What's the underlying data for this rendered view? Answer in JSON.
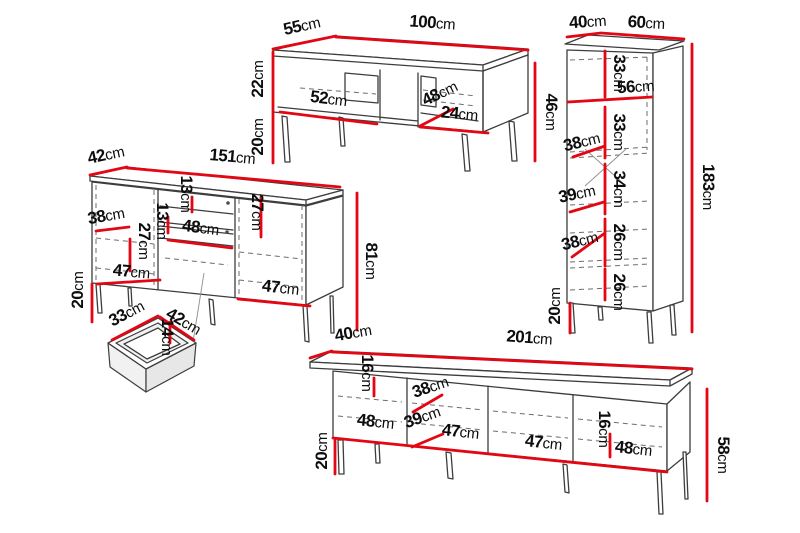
{
  "unit": "cm",
  "colors": {
    "dimension_line": "#e30613",
    "drawing_outline": "#3d3d3d",
    "label_text": "#0d0d0d",
    "background": "#ffffff"
  },
  "pieces": {
    "coffee_table": {
      "dims": [
        "55",
        "100",
        "22",
        "20",
        "52",
        "48",
        "24",
        "46"
      ]
    },
    "tall_cabinet": {
      "dims": [
        "40",
        "60",
        "33",
        "56",
        "33",
        "38",
        "34",
        "39",
        "26",
        "38",
        "26",
        "20",
        "183"
      ]
    },
    "sideboard": {
      "dims": [
        "42",
        "151",
        "38",
        "27",
        "13",
        "13",
        "48",
        "27",
        "47",
        "20",
        "47",
        "81"
      ]
    },
    "drawer": {
      "dims": [
        "33",
        "42",
        "14"
      ]
    },
    "tv_stand": {
      "dims": [
        "40",
        "201",
        "16",
        "38",
        "48",
        "39",
        "47",
        "47",
        "16",
        "48",
        "20",
        "58"
      ]
    }
  }
}
